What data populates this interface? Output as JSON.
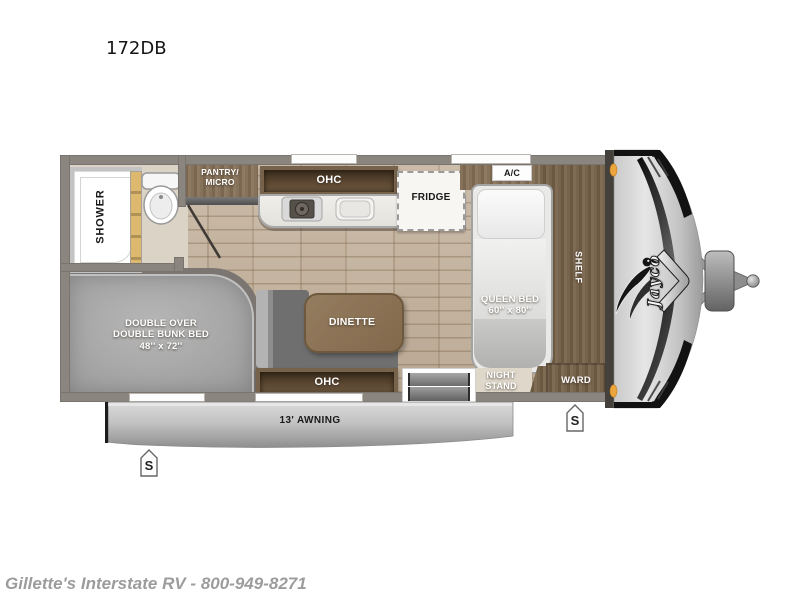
{
  "title": "172DB",
  "floorplan": {
    "bathroom": {
      "shower_label": "SHOWER"
    },
    "kitchen": {
      "pantry_label_line1": "PANTRY/",
      "pantry_label_line2": "MICRO",
      "ohc_label": "OHC",
      "fridge_label": "FRIDGE"
    },
    "living": {
      "dinette_label": "DINETTE",
      "ohc_label": "OHC"
    },
    "bunk_room": {
      "bunk_label_line1": "DOUBLE OVER",
      "bunk_label_line2": "DOUBLE BUNK BED",
      "bunk_label_line3": "48'' x 72''"
    },
    "bedroom": {
      "ac_label": "A/C",
      "queen_bed_label_line1": "QUEEN BED",
      "queen_bed_label_line2": "60'' x 80''",
      "shelf_label": "SHELF",
      "night_stand_label_line1": "NIGHT",
      "night_stand_label_line2": "STAND",
      "ward_label": "WARD"
    },
    "exterior": {
      "awning_label": "13' AWNING",
      "brand_logo": "Jayco",
      "stabilizer_marker": "S"
    }
  },
  "footer": {
    "dealer_info": "Gillette's Interstate RV - 800-949-8271"
  },
  "colors": {
    "wall": "#8b8580",
    "floor_wood": "#c1b09c",
    "bathroom_floor": "#dad3c6",
    "cabinet_wood": "#7f6c55",
    "cabinet_dark": "#463526",
    "counter": "#edebe7",
    "bunk_gray": "#a9a9a9",
    "seat_gray": "#6f6f6f",
    "awning_gray": "#bdbdbd",
    "clearance_light": "#eda63e",
    "footer_text": "#9c9c9c"
  }
}
